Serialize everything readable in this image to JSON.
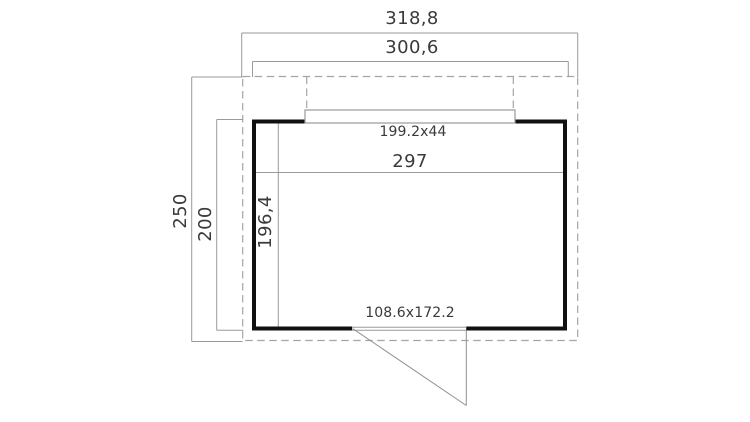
{
  "plan": {
    "dimension_labels": {
      "overall_width": "318,8",
      "outer_wall_width": "300,6",
      "overall_depth": "250",
      "outer_wall_depth": "200",
      "inner_width": "297",
      "inner_depth": "196,4",
      "window_size": "199.2x44",
      "door_size": "108.6x172.2"
    },
    "colors": {
      "wall_outline": "#111111",
      "dimension_lines": "#9a9a9a",
      "dashed_outline": "#a5a5a5",
      "label_text": "#3a3a3a",
      "background": "#ffffff"
    }
  }
}
